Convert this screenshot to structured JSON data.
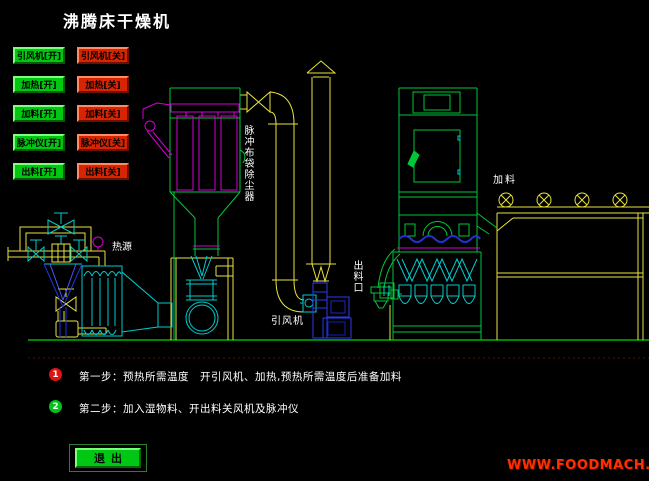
{
  "title": "沸腾床干燥机",
  "controls": {
    "rows": [
      {
        "on": "引风机[开]",
        "off": "引风机[关]"
      },
      {
        "on": "加热[开]",
        "off": "加热[关]"
      },
      {
        "on": "加料[开]",
        "off": "加料[关]"
      },
      {
        "on": "脉冲仪[开]",
        "off": "脉冲仪[关]"
      },
      {
        "on": "出料[开]",
        "off": "出料[关]"
      }
    ],
    "on_color": "#00c710",
    "off_color": "#d62500"
  },
  "diagram": {
    "labels": {
      "bag_filter": "脉冲布袋除尘器",
      "heat_source": "热源",
      "fan": "引风机",
      "discharge_port": "出料口",
      "feed": "加料"
    },
    "line_colors": {
      "green": "#00c73a",
      "yellow": "#e8e33c",
      "magenta": "#d400d4",
      "cyan": "#00cdcd",
      "blue": "#2a3aef"
    }
  },
  "steps": [
    {
      "num": "1",
      "text": "第一步：预热所需温度　开引风机、加热,预热所需温度后准备加料"
    },
    {
      "num": "2",
      "text": "第二步：加入湿物料、开出料关风机及脉冲仪"
    }
  ],
  "footer": {
    "exit_label": "退出",
    "website": "WWW.FOODMACH.CN",
    "website_color": "#ff3000"
  }
}
